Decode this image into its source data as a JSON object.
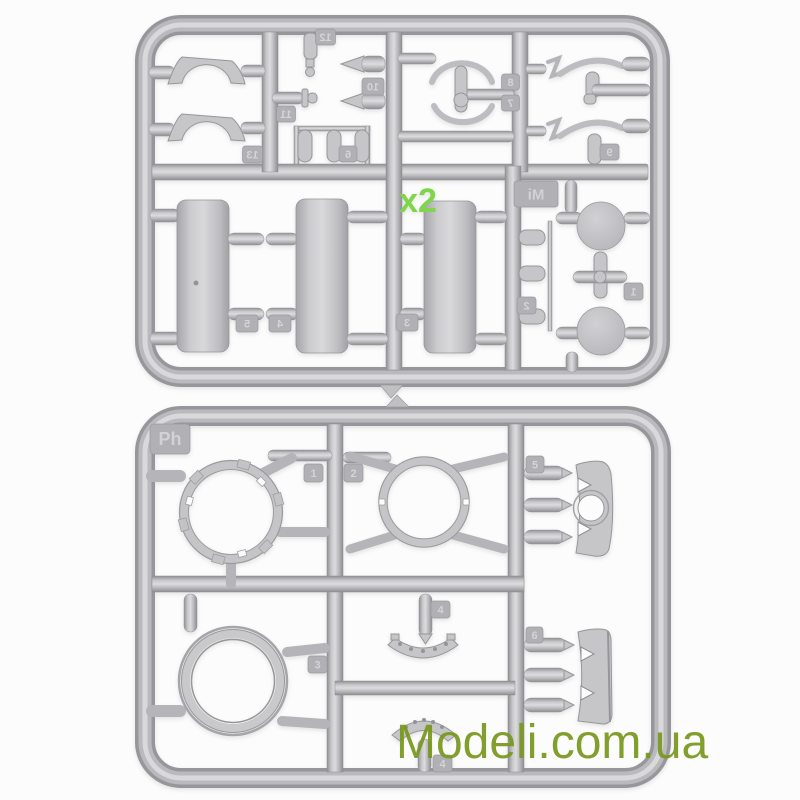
{
  "photo": {
    "subject": "Two grey injection-moulded plastic model-kit sprues photographed on a white background",
    "background_color": "#fcfcfc",
    "plastic_color": "#bdbdc1",
    "plastic_highlight": "#dadadc",
    "plastic_shadow": "#8f8f93"
  },
  "upper_sprue": {
    "brand_tag": "Mi",
    "numbers_mirrored": true,
    "quantity_note": {
      "text": "x2",
      "color": "#80d64b"
    },
    "part_tags": {
      "1": "1",
      "2": "2",
      "3": "3",
      "4": "4",
      "5": "5",
      "6": "6",
      "7": "7",
      "8": "8",
      "9": "9",
      "10": "10",
      "11": "11",
      "12": "12",
      "13": "13"
    }
  },
  "lower_sprue": {
    "brand_tag": "Ph",
    "numbers_mirrored": false,
    "part_tags": {
      "1": "1",
      "2": "2",
      "3": "3",
      "4": "4",
      "5": "5",
      "6": "6"
    }
  },
  "watermark": {
    "text": "Modeli.com.ua",
    "color": "#79981f"
  }
}
